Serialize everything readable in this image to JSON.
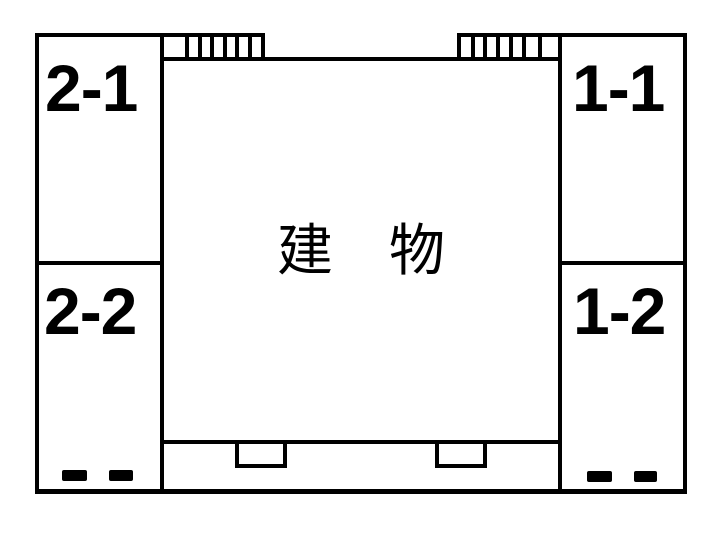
{
  "building": {
    "label": "建　物"
  },
  "units": [
    {
      "id": "2-1"
    },
    {
      "id": "2-2"
    },
    {
      "id": "1-1"
    },
    {
      "id": "1-2"
    }
  ],
  "symbols": {
    "hatch_left": "stairs-hatch",
    "hatch_right": "stairs-hatch",
    "entry_left": "entry-step",
    "entry_right": "entry-step",
    "stopper_marks": "wheel-stopper-bars"
  },
  "colors": {
    "line": "#000000",
    "background": "#ffffff"
  }
}
